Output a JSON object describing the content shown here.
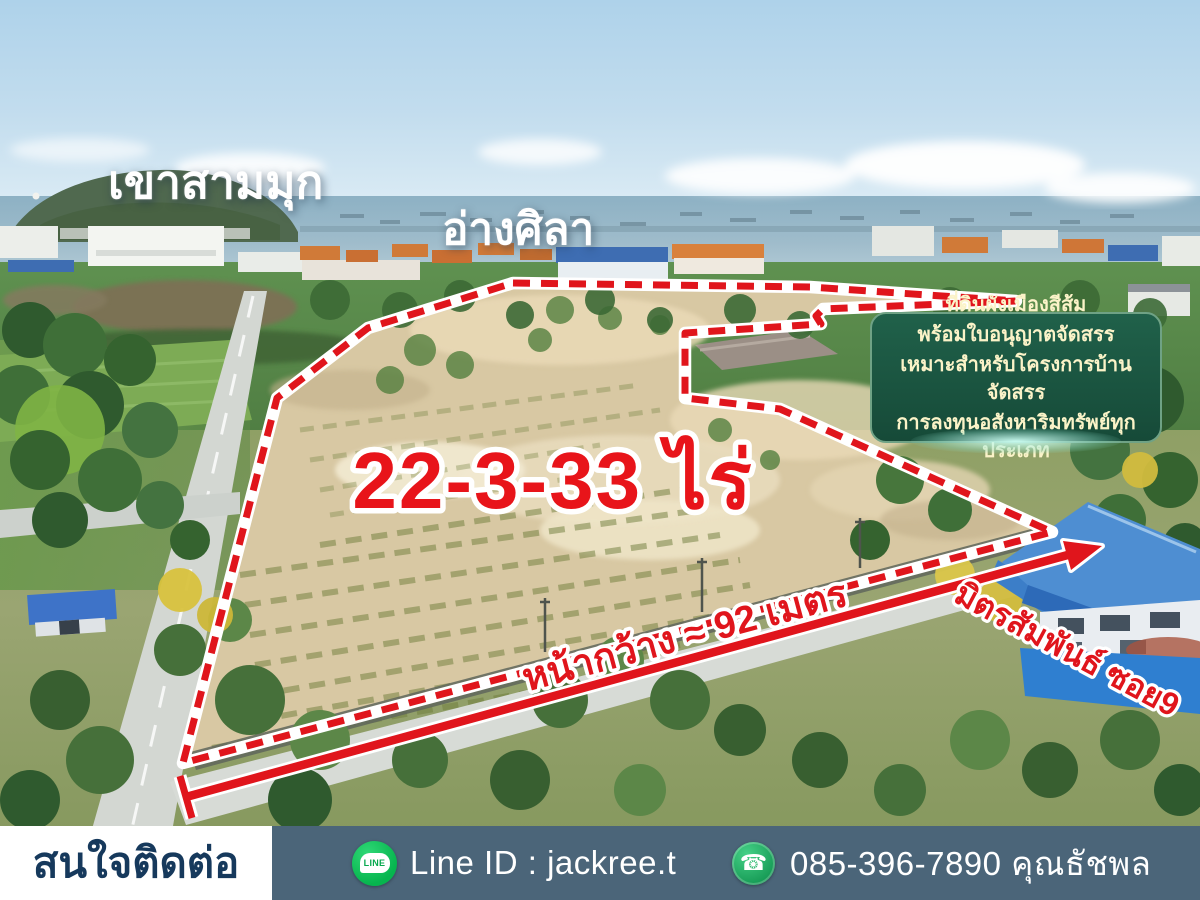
{
  "texts": {
    "hill_label": "เขาสามมุก",
    "bay_label": "อ่างศิลา",
    "area_size": "22-3-33 ไร่",
    "frontage": "หน้ากว้าง ≈ 92 เมตร",
    "road_name": "มิตรสัมพันธ์ ซอย9"
  },
  "info_box": {
    "lines": [
      "ที่ดินผังเมืองสีส้ม",
      "พร้อมใบอนุญาตจัดสรร",
      "เหมาะสำหรับโครงการบ้านจัดสรร",
      "การลงทุนอสังหาริมทรัพย์ทุกประเภท"
    ],
    "bg": "#1b5a43",
    "border": "#6fa285",
    "text_color": "#fbf3c8"
  },
  "footer": {
    "contact_label": "สนใจติดต่อ",
    "line_icon_text": "LINE",
    "line_id": "Line ID : jackree.t",
    "phone": "085-396-7890 คุณธัชพล",
    "bar_bg": "#4b6579",
    "label_bg": "#ffffff",
    "label_color": "#16395c",
    "line_green": "#06c755",
    "phone_green": "#2eb873"
  },
  "colors": {
    "boundary_red": "#e0151c",
    "outline_white": "#ffffff",
    "area_text_red": "#e8141a"
  }
}
